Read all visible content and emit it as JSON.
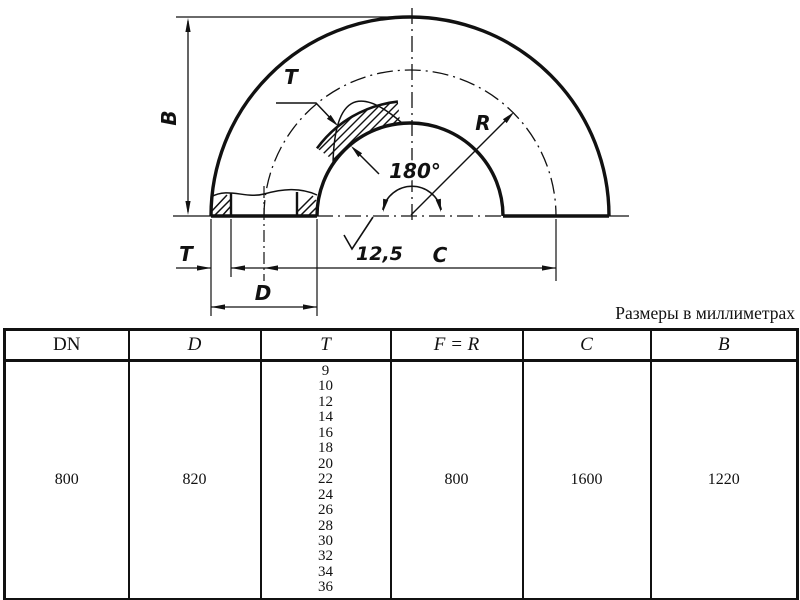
{
  "note": "Размеры в миллиметрах",
  "drawing": {
    "labels": {
      "b": "B",
      "t_section": "T",
      "t_wall": "T",
      "d": "D",
      "c": "C",
      "r": "R",
      "angle": "180°",
      "roughness": "12,5"
    }
  },
  "table": {
    "headers": [
      "DN",
      "D",
      "T",
      "F  =  R",
      "C",
      "B"
    ],
    "row": {
      "dn": "800",
      "d": "820",
      "t_values": [
        "9",
        "10",
        "12",
        "14",
        "16",
        "18",
        "20",
        "22",
        "24",
        "26",
        "28",
        "30",
        "32",
        "34",
        "36"
      ],
      "f_r": "800",
      "c": "1600",
      "b": "1220"
    }
  }
}
